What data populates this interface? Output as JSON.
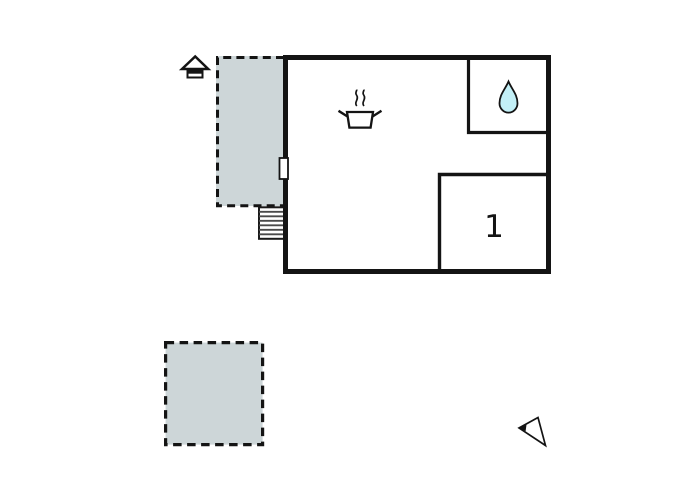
{
  "canvas": {
    "width": 700,
    "height": 500,
    "background": "#ffffff"
  },
  "colors": {
    "wall": "#141414",
    "terrace_fill": "#cdd6d8",
    "water_drop_fill": "#c3f0f7",
    "stair_tread": "#4a4a4a"
  },
  "building": {
    "type": "holiday-home-floor-plan",
    "rooms": [
      {
        "id": "living-room-kitchen",
        "label": "",
        "icon": "cooking-pot-icon"
      },
      {
        "id": "bathroom",
        "label": "",
        "icon": "water-drop-icon"
      },
      {
        "id": "bedroom-1",
        "label": "1",
        "icon": ""
      }
    ],
    "stairs": {
      "steps": 7
    },
    "doors": 1
  },
  "outdoor": {
    "terraces": [
      {
        "id": "terrace-upper"
      },
      {
        "id": "terrace-lower"
      }
    ],
    "entrance_icon": "entrance-house-icon",
    "compass_icon": "north-compass-icon"
  }
}
